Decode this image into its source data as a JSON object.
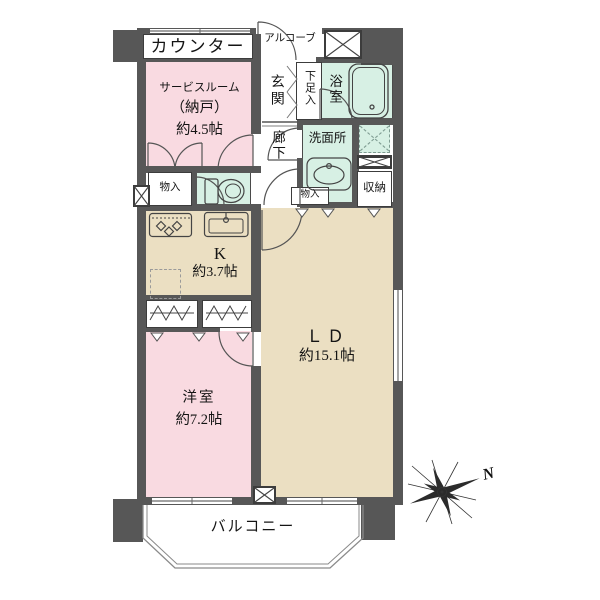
{
  "title": "floor-plan",
  "rooms": {
    "counter": {
      "label": "カウンター"
    },
    "service_room": {
      "name": "サービスルーム",
      "sub": "（納戸）",
      "size": "約4.5帖"
    },
    "alcove": {
      "label": "アルコーブ"
    },
    "entrance": {
      "label": "玄関"
    },
    "shoe_box": {
      "label": "下足入"
    },
    "bathroom": {
      "label": "浴室"
    },
    "hallway": {
      "label": "廊下"
    },
    "washroom": {
      "label": "洗面所"
    },
    "storage_left": {
      "label": "物入"
    },
    "storage_hall": {
      "label": "物入"
    },
    "closet_ld": {
      "label": "収納"
    },
    "kitchen": {
      "label": "K",
      "size": "約3.7帖"
    },
    "living_dining": {
      "label": "ＬＤ",
      "size": "約15.1帖"
    },
    "western_room": {
      "label": "洋室",
      "size": "約7.2帖"
    },
    "balcony": {
      "label": "バルコニー"
    }
  },
  "compass": {
    "label": "N"
  },
  "colors": {
    "wall": "#575757",
    "room_pink": "#f9dae1",
    "room_tan": "#ebdfc2",
    "room_teal": "#d7f0e4",
    "line": "#555555"
  }
}
